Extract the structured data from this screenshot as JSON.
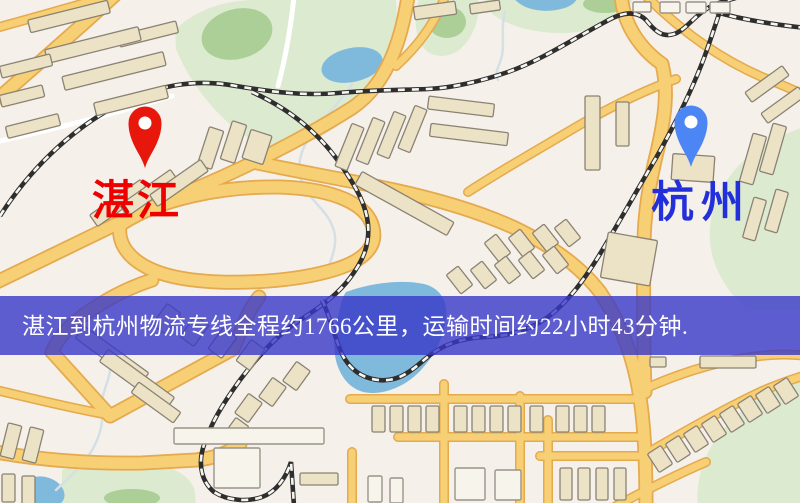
{
  "window": {
    "width": 800,
    "height": 503,
    "kind": "map-screenshot"
  },
  "map": {
    "kind": "stylized street map with route endpoints",
    "origin_marker": {
      "label": "湛江",
      "label_color": "#ee0000",
      "pin_color": "#e8170b",
      "pin_icon": "map-pin-icon"
    },
    "destination_marker": {
      "label": "杭州",
      "label_color": "#2330d9",
      "pin_color": "#4c86f5",
      "pin_icon": "map-pin-icon"
    },
    "palette": {
      "background": "#f5f1ea",
      "road": "#f7cf74",
      "road_casing": "#e5a94e",
      "park": "#dcead0",
      "park_dark": "#abcf97",
      "water": "#7fbadc",
      "building": "#ece2c6",
      "building_stroke": "#8a8274",
      "railway": "#2e2e2e"
    }
  },
  "banner": {
    "text": "湛江到杭州物流专线全程约1766公里，运输时间约22小时43分钟.",
    "background": "rgba(56,56,200,0.8)",
    "text_color": "#ffffff",
    "route": {
      "origin": "湛江",
      "destination": "杭州",
      "distance_km": "1766",
      "duration_hours": "22",
      "duration_minutes": "43"
    }
  }
}
